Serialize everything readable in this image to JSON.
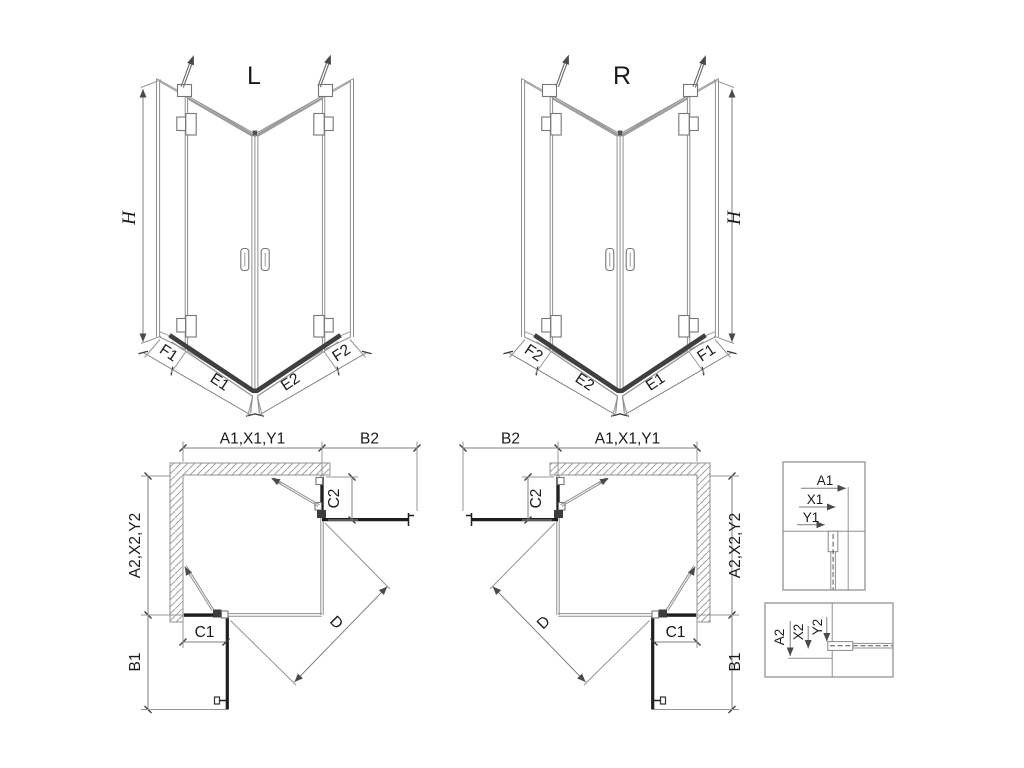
{
  "views": {
    "iso_left": {
      "title": "L",
      "height_label": "H",
      "bottom_segments": {
        "outer_left": "F1",
        "inner_left": "E1",
        "inner_right": "E2",
        "outer_right": "F2"
      }
    },
    "iso_right": {
      "title": "R",
      "height_label": "H",
      "bottom_segments": {
        "outer_left": "F2",
        "inner_left": "E2",
        "inner_right": "E1",
        "outer_right": "F1"
      }
    },
    "plan_left": {
      "top_width": "A1,X1,Y1",
      "door_extension_top": "B2",
      "fixed_panel_top": "C2",
      "side_depth": "A2,X2,Y2",
      "fixed_panel_bottom": "C1",
      "door_extension_bottom": "B1",
      "diagonal": "D"
    },
    "plan_right": {
      "top_width": "A1,X1,Y1",
      "door_extension_top": "B2",
      "fixed_panel_top": "C2",
      "side_depth": "A2,X2,Y2",
      "fixed_panel_bottom": "C1",
      "door_extension_bottom": "B1",
      "diagonal": "D"
    },
    "detail_top": {
      "dim_a": "A1",
      "dim_x": "X1",
      "dim_y": "Y1"
    },
    "detail_bottom": {
      "dim_a": "A2",
      "dim_x": "X2",
      "dim_y": "Y2"
    }
  },
  "colors": {
    "background": "#ffffff",
    "thin_line": "#909090",
    "dark_line": "#1f1f1f",
    "tray_line": "#3f3f3f",
    "text": "#1a1a1a"
  }
}
